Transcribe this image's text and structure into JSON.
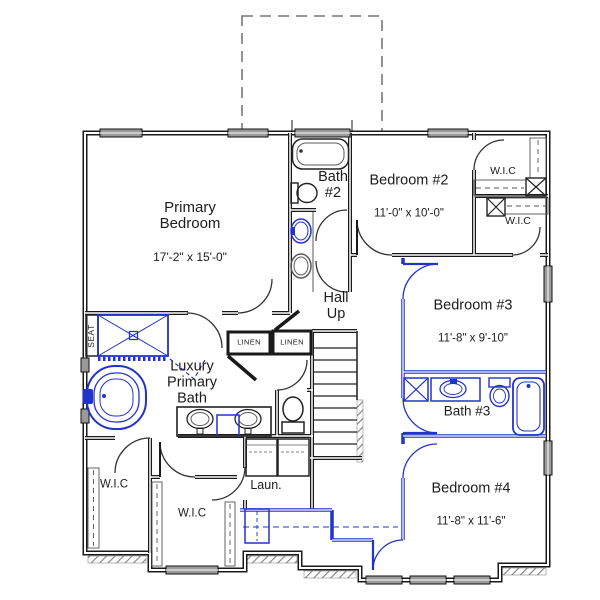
{
  "floor_plan": {
    "rooms": {
      "primary_bedroom": {
        "name": "Primary\nBedroom",
        "dims": "17'-2\" x 15'-0\""
      },
      "bath_2": {
        "name": "Bath\n#2"
      },
      "bedroom_2": {
        "name": "Bedroom #2",
        "dims": "11'-0\" x 10'-0\""
      },
      "wic_bedroom2": {
        "name": "W.I.C"
      },
      "wic_bedroom3": {
        "name": "W.I.C"
      },
      "hall": {
        "name": "Hall\nUp"
      },
      "linen_1": {
        "name": "LINEN"
      },
      "linen_2": {
        "name": "LINEN"
      },
      "bedroom_3": {
        "name": "Bedroom #3",
        "dims": "11'-8\" x 9'-10\""
      },
      "luxury_primary_bath": {
        "name": "Luxury\nPrimary\nBath"
      },
      "shower_seat": {
        "name": "SEAT"
      },
      "bath_3": {
        "name": "Bath #3"
      },
      "wic_primary_left": {
        "name": "W.I.C"
      },
      "wic_primary_center": {
        "name": "W.I.C"
      },
      "laundry": {
        "name": "Laun."
      },
      "bedroom_4": {
        "name": "Bedroom #4",
        "dims": "11'-8\" x 11'-6\""
      }
    },
    "colors": {
      "wall": "#1a1a1a",
      "optional_blue": "#2233cc",
      "window_fill": "#9a9a9a",
      "roof_dash": "#777777",
      "background": "#ffffff"
    }
  }
}
